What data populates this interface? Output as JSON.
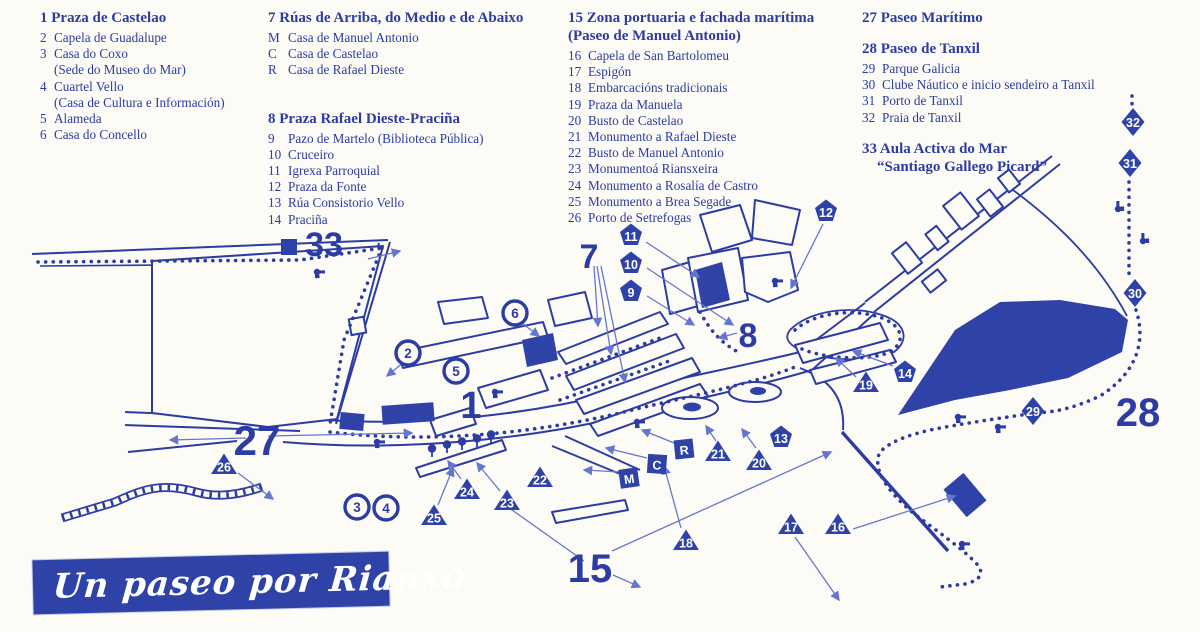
{
  "colors": {
    "ink": "#2c3ca2",
    "fill": "#2e42a8",
    "arrow": "#6577cd",
    "paper": "#fcfbf6",
    "banner_bg": "#2e42a8",
    "banner_text": "#ffffff"
  },
  "banner": {
    "title": "Un paseo por Rianxo"
  },
  "legend": {
    "groups": [
      {
        "title": "1 Praza de Castelao",
        "items": [
          {
            "num": "2",
            "text": "Capela de Guadalupe"
          },
          {
            "num": "3",
            "text": "Casa do Coxo"
          },
          {
            "num": "",
            "text": "(Sede do Museo do Mar)"
          },
          {
            "num": "4",
            "text": "Cuartel Vello"
          },
          {
            "num": "",
            "text": "(Casa de Cultura e Información)"
          },
          {
            "num": "5",
            "text": "Alameda"
          },
          {
            "num": "6",
            "text": "Casa do Concello"
          }
        ]
      },
      {
        "title": "7 Rúas de Arriba, do Medio e de Abaixo",
        "items": [
          {
            "num": "M",
            "text": "Casa de Manuel Antonio"
          },
          {
            "num": "C",
            "text": "Casa de Castelao"
          },
          {
            "num": "R",
            "text": "Casa de Rafael Dieste"
          }
        ]
      },
      {
        "title": "8 Praza Rafael Dieste-Praciña",
        "items": [
          {
            "num": "9",
            "text": "Pazo de Martelo (Biblioteca Pública)"
          },
          {
            "num": "10",
            "text": "Cruceiro"
          },
          {
            "num": "11",
            "text": "Igrexa Parroquial"
          },
          {
            "num": "12",
            "text": "Praza da Fonte"
          },
          {
            "num": "13",
            "text": "Rúa Consistorio Vello"
          },
          {
            "num": "14",
            "text": "Praciña"
          }
        ]
      },
      {
        "title": "15 Zona portuaria e fachada marítima",
        "title2": "(Paseo de Manuel Antonio)",
        "items": [
          {
            "num": "16",
            "text": "Capela de San Bartolomeu"
          },
          {
            "num": "17",
            "text": "Espigón"
          },
          {
            "num": "18",
            "text": "Embarcacións tradicionais"
          },
          {
            "num": "19",
            "text": "Praza da Manuela"
          },
          {
            "num": "20",
            "text": "Busto de Castelao"
          },
          {
            "num": "21",
            "text": "Monumento a Rafael Dieste"
          },
          {
            "num": "22",
            "text": "Busto de Manuel Antonio"
          },
          {
            "num": "23",
            "text": "Monumentoá Riansxeira"
          },
          {
            "num": "24",
            "text": "Monumento a Rosalía de Castro"
          },
          {
            "num": "25",
            "text": "Monumento a Brea Segade"
          },
          {
            "num": "26",
            "text": "Porto de Setrefogas"
          }
        ]
      },
      {
        "title": "27 Paseo Marítimo",
        "items": []
      },
      {
        "title": "28 Paseo de Tanxil",
        "items": [
          {
            "num": "29",
            "text": "Parque Galicia"
          },
          {
            "num": "30",
            "text": "Clube Náutico e inicio sendeiro a Tanxil"
          },
          {
            "num": "31",
            "text": "Porto de Tanxil"
          },
          {
            "num": "32",
            "text": "Praia de Tanxil"
          }
        ]
      },
      {
        "title": "33 Aula Activa do Mar",
        "title2": "“Santiago Gallego Picard”",
        "items": []
      }
    ]
  },
  "map": {
    "markers": [
      {
        "label": "2",
        "shape": "circle",
        "x": 408,
        "y": 353
      },
      {
        "label": "3",
        "shape": "circle",
        "x": 357,
        "y": 507
      },
      {
        "label": "4",
        "shape": "circle",
        "x": 386,
        "y": 508
      },
      {
        "label": "5",
        "shape": "circle",
        "x": 456,
        "y": 371
      },
      {
        "label": "6",
        "shape": "circle",
        "x": 515,
        "y": 313
      },
      {
        "label": "9",
        "shape": "pentagon",
        "x": 631,
        "y": 291
      },
      {
        "label": "10",
        "shape": "pentagon",
        "x": 631,
        "y": 263
      },
      {
        "label": "11",
        "shape": "pentagon",
        "x": 631,
        "y": 235
      },
      {
        "label": "12",
        "shape": "pentagon",
        "x": 826,
        "y": 211
      },
      {
        "label": "13",
        "shape": "pentagon",
        "x": 781,
        "y": 437
      },
      {
        "label": "14",
        "shape": "pentagon",
        "x": 905,
        "y": 372
      },
      {
        "label": "M",
        "shape": "square",
        "x": 629,
        "y": 478,
        "rot": -8
      },
      {
        "label": "C",
        "shape": "square",
        "x": 657,
        "y": 464,
        "rot": 4
      },
      {
        "label": "R",
        "shape": "square",
        "x": 684,
        "y": 449,
        "rot": -6
      },
      {
        "label": "16",
        "shape": "triangle",
        "x": 838,
        "y": 525
      },
      {
        "label": "17",
        "shape": "triangle",
        "x": 791,
        "y": 525
      },
      {
        "label": "18",
        "shape": "triangle",
        "x": 686,
        "y": 541
      },
      {
        "label": "19",
        "shape": "triangle",
        "x": 866,
        "y": 383
      },
      {
        "label": "20",
        "shape": "triangle",
        "x": 759,
        "y": 461
      },
      {
        "label": "21",
        "shape": "triangle",
        "x": 718,
        "y": 452
      },
      {
        "label": "22",
        "shape": "triangle",
        "x": 540,
        "y": 478
      },
      {
        "label": "23",
        "shape": "triangle",
        "x": 507,
        "y": 501
      },
      {
        "label": "24",
        "shape": "triangle",
        "x": 467,
        "y": 490
      },
      {
        "label": "25",
        "shape": "triangle",
        "x": 434,
        "y": 516
      },
      {
        "label": "26",
        "shape": "triangle",
        "x": 224,
        "y": 465
      },
      {
        "label": "29",
        "shape": "diamond",
        "x": 1033,
        "y": 411
      },
      {
        "label": "30",
        "shape": "diamond",
        "x": 1135,
        "y": 293
      },
      {
        "label": "31",
        "shape": "diamond",
        "x": 1130,
        "y": 163
      },
      {
        "label": "32",
        "shape": "diamond",
        "x": 1133,
        "y": 122
      },
      {
        "label": "",
        "shape": "square-solid",
        "x": 289,
        "y": 247
      }
    ],
    "big_labels": [
      {
        "text": "1",
        "x": 471,
        "y": 418,
        "size": 38
      },
      {
        "text": "7",
        "x": 589,
        "y": 268,
        "size": 34
      },
      {
        "text": "8",
        "x": 748,
        "y": 347,
        "size": 34
      },
      {
        "text": "15",
        "x": 590,
        "y": 582,
        "size": 40
      },
      {
        "text": "27",
        "x": 257,
        "y": 455,
        "size": 42
      },
      {
        "text": "28",
        "x": 1138,
        "y": 426,
        "size": 40
      },
      {
        "text": "33",
        "x": 324,
        "y": 256,
        "size": 34
      }
    ]
  }
}
